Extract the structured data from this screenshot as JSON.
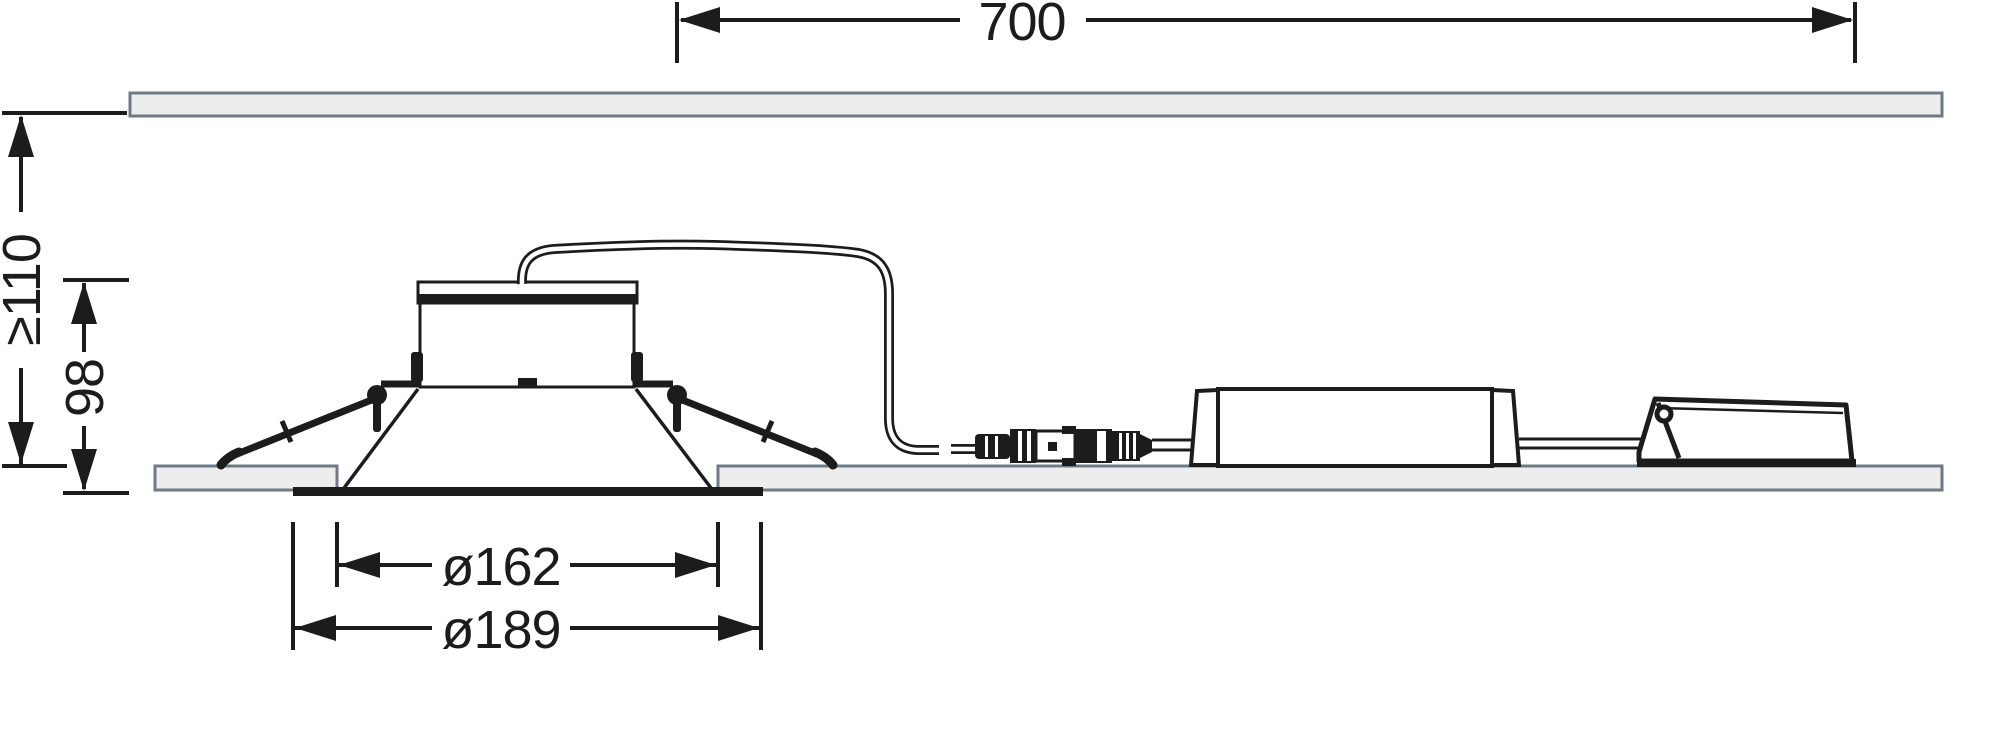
{
  "labels": {
    "cable_run": "700",
    "recess_depth_min": "≥110",
    "fixture_height": "98",
    "cutout_diameter": "ø162",
    "outer_diameter": "ø189"
  },
  "colors": {
    "line": "#1c1c1c",
    "panel_fill": "#ededed",
    "panel_border": "#6e7b86",
    "background": "#ffffff"
  }
}
